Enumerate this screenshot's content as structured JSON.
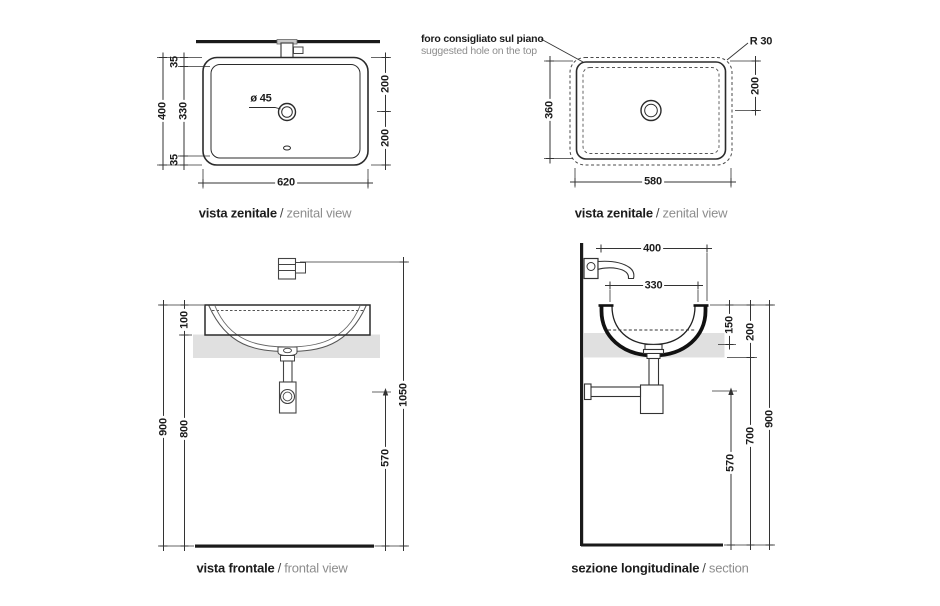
{
  "views": {
    "plan_left": {
      "title_it": "vista zenitale",
      "title_divider": "/",
      "title_en": "zenital view",
      "dim_overall_height": "400",
      "dim_rim_top": "35",
      "dim_inner_height": "330",
      "dim_rim_bottom": "35",
      "dim_center_top": "200",
      "dim_center_bottom": "200",
      "dim_width": "620",
      "label_drain": "ø 45"
    },
    "plan_right": {
      "title_it": "vista zenitale",
      "title_divider": "/",
      "title_en": "zenital view",
      "note_it": "foro consigliato sul piano",
      "note_en": "suggested hole on the top",
      "label_radius": "R 30",
      "dim_height": "360",
      "dim_center": "200",
      "dim_width": "580"
    },
    "front": {
      "title_it": "vista frontale",
      "title_divider": "/",
      "title_en": "frontal view",
      "dim_total_height": "900",
      "dim_basin_reveal": "100",
      "dim_under_counter": "800",
      "dim_drain_height": "570",
      "dim_faucet_height": "1050"
    },
    "section": {
      "title_it": "sezione longitudinale",
      "title_divider": "/",
      "title_en": "section",
      "dim_depth": "400",
      "dim_inner_depth": "330",
      "dim_bowl_depth": "150",
      "dim_basin_height": "200",
      "dim_under_counter": "700",
      "dim_total_height": "900",
      "dim_drain_height": "570"
    }
  },
  "colors": {
    "line": "#333333",
    "object_line": "#2b2b2b",
    "counter_fill": "#e0e0e0",
    "text_dark": "#1c1c1c",
    "text_light": "#8d8d8d"
  }
}
